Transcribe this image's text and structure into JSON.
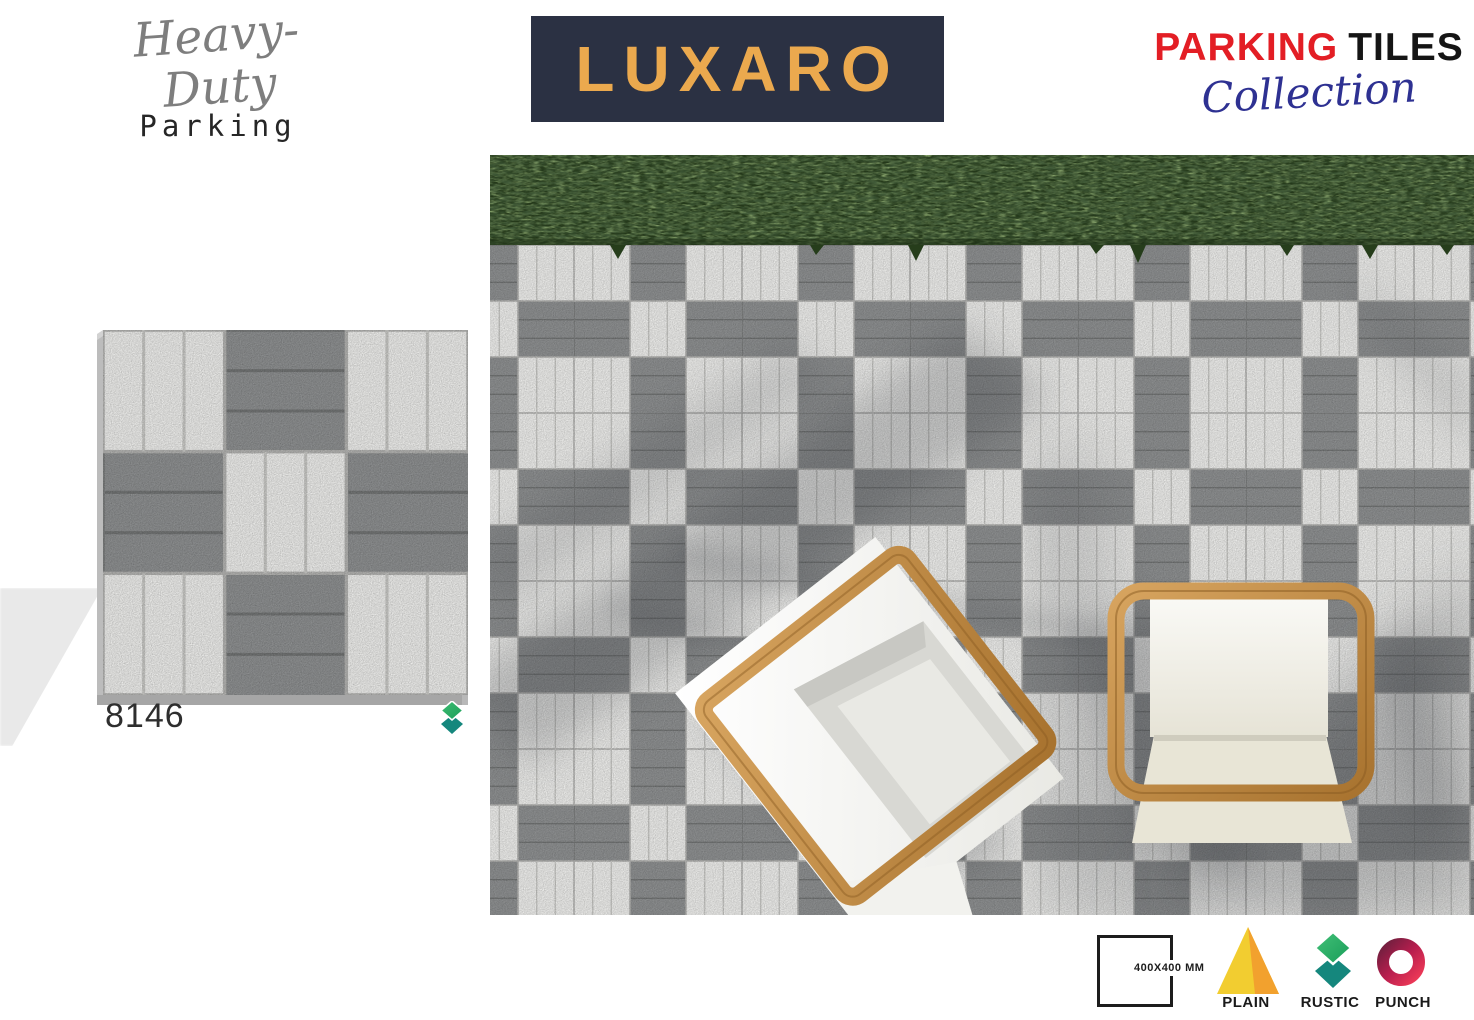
{
  "header": {
    "tagline": {
      "script": "Heavy-Duty",
      "sub": "Parking"
    },
    "brand": {
      "text": "LUXARO",
      "bg_color": "#2b3143",
      "text_color": "#eba94e"
    },
    "collection": {
      "word1": "PARKING",
      "word2": "TILES",
      "script": "Collection",
      "word1_color": "#e31e25",
      "word2_color": "#151515",
      "script_color": "#2e3192"
    }
  },
  "product": {
    "code": "8146",
    "finish": "RUSTIC"
  },
  "legend": {
    "size_label": "400X400 MM",
    "finishes": [
      {
        "label": "PLAIN"
      },
      {
        "label": "RUSTIC"
      },
      {
        "label": "PUNCH"
      }
    ]
  },
  "colors": {
    "tile_white": "#ebebe9",
    "tile_gray": "#8d8f90",
    "grass_green": "#293e1d",
    "wood": "#c18a47",
    "plain_yellow": "#f2cd30",
    "plain_orange": "#f2a12e",
    "rustic_green": "#2eb36b",
    "rustic_teal": "#15877d",
    "punch_dark": "#6f1f3e",
    "punch_red": "#f03a57"
  }
}
